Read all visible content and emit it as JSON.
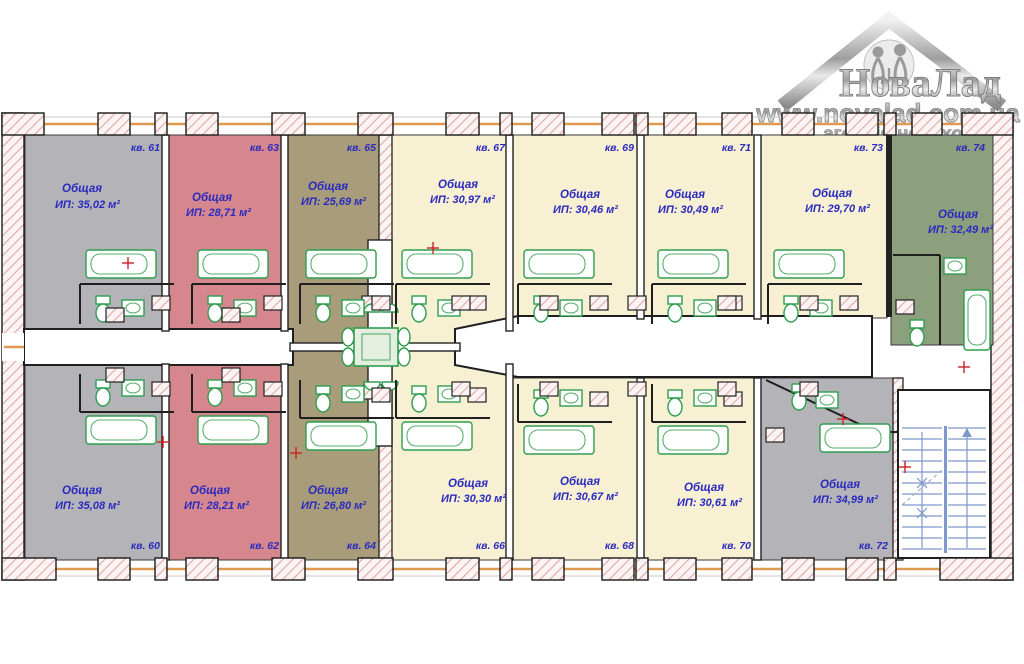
{
  "logo": {
    "brand": "НоваЛад",
    "url": "www.novalad.com.ua",
    "tagline": "агенція нерухомості"
  },
  "apartments": [
    {
      "id": "61",
      "number": "кв. 61",
      "label": "Общая",
      "value": "ИП: 35,02 м²",
      "color": "#b4b4b8"
    },
    {
      "id": "63",
      "number": "кв. 63",
      "label": "Общая",
      "value": "ИП: 28,71 м²",
      "color": "#d6878d"
    },
    {
      "id": "65",
      "number": "кв. 65",
      "label": "Общая",
      "value": "ИП: 25,69 м²",
      "color": "#a89c7a"
    },
    {
      "id": "67",
      "number": "кв. 67",
      "label": "Общая",
      "value": "ИП: 30,97 м²",
      "color": "#f7f0d2"
    },
    {
      "id": "69",
      "number": "кв. 69",
      "label": "Общая",
      "value": "ИП: 30,46 м²",
      "color": "#f7f0d2"
    },
    {
      "id": "71",
      "number": "кв. 71",
      "label": "Общая",
      "value": "ИП: 30,49 м²",
      "color": "#f7f0d2"
    },
    {
      "id": "73",
      "number": "кв. 73",
      "label": "Общая",
      "value": "ИП: 29,70 м²",
      "color": "#f7f0d2"
    },
    {
      "id": "74",
      "number": "кв. 74",
      "label": "Общая",
      "value": "ИП: 32,49 м²",
      "color": "#8ca07e"
    },
    {
      "id": "60",
      "number": "кв. 60",
      "label": "Общая",
      "value": "ИП: 35,08 м²",
      "color": "#b4b4b8"
    },
    {
      "id": "62",
      "number": "кв. 62",
      "label": "Общая",
      "value": "ИП: 28,21 м²",
      "color": "#d6878d"
    },
    {
      "id": "64",
      "number": "кв. 64",
      "label": "Общая",
      "value": "ИП: 26,80 м²",
      "color": "#a89c7a"
    },
    {
      "id": "66",
      "number": "кв. 66",
      "label": "Общая",
      "value": "ИП: 30,30 м²",
      "color": "#f7f0d2"
    },
    {
      "id": "68",
      "number": "кв. 68",
      "label": "Общая",
      "value": "ИП: 30,67 м²",
      "color": "#f7f0d2"
    },
    {
      "id": "70",
      "number": "кв. 70",
      "label": "Общая",
      "value": "ИП: 30,61 м²",
      "color": "#f7f0d2"
    },
    {
      "id": "72",
      "number": "кв. 72",
      "label": "Общая",
      "value": "ИП: 34,99 м²",
      "color": "#b4b4b8"
    }
  ],
  "colors": {
    "wall_hatch": "#dfa8a8",
    "window_line": "#de9a50",
    "fixture_green": "#2e9e4f",
    "text_blue": "#2a2ac0",
    "stairs_blue": "#7f97c9"
  }
}
